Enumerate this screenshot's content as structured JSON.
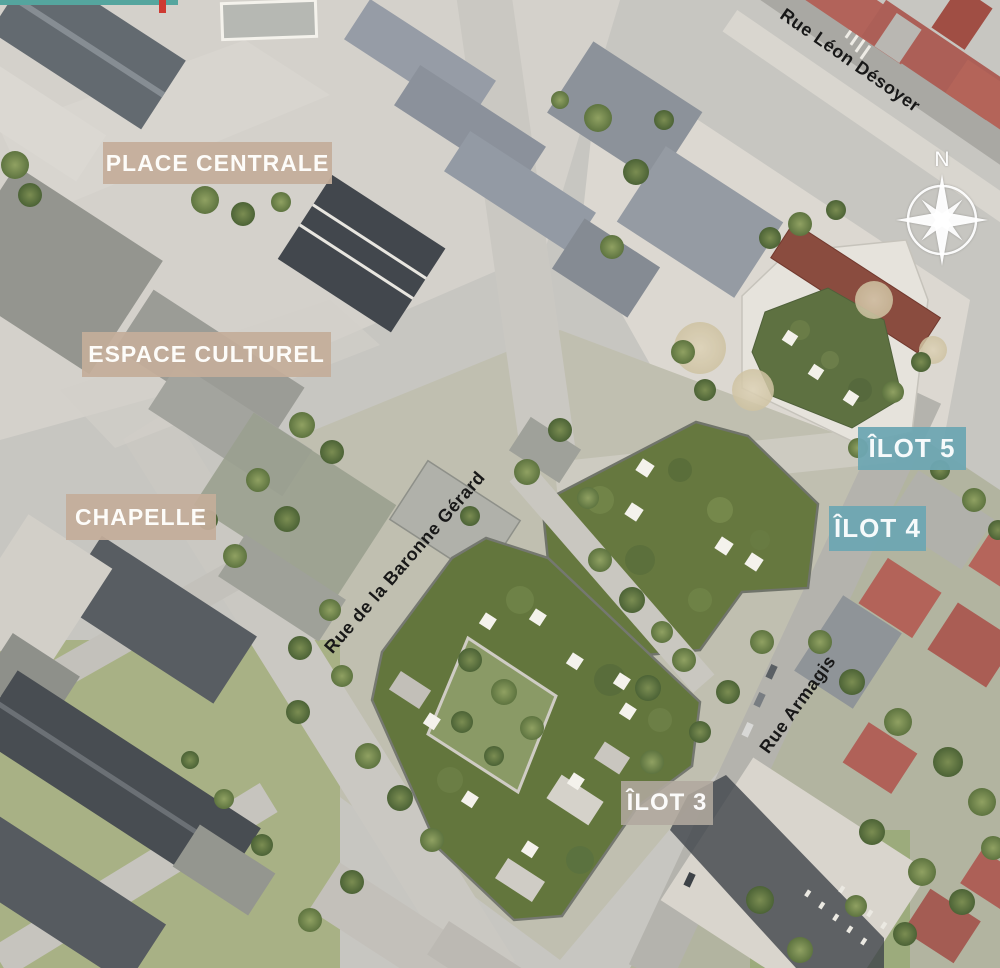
{
  "map": {
    "area_labels": [
      {
        "id": "place-centrale",
        "text": "PLACE CENTRALE"
      },
      {
        "id": "espace-culturel",
        "text": "ESPACE CULTUREL"
      },
      {
        "id": "chapelle",
        "text": "CHAPELLE"
      }
    ],
    "block_labels": [
      {
        "id": "ilot-5",
        "text": "ÎLOT 5"
      },
      {
        "id": "ilot-4",
        "text": "ÎLOT 4"
      },
      {
        "id": "ilot-3",
        "text": "ÎLOT 3"
      }
    ],
    "street_labels": [
      {
        "id": "rue-leon-desoyer",
        "text": "Rue Léon Désoyer"
      },
      {
        "id": "rue-de-la-baronne-gerard",
        "text": "Rue de la Baronne Gérard"
      },
      {
        "id": "rue-armagis",
        "text": "Rue Armagis"
      }
    ],
    "compass": {
      "north_label": "N",
      "icon": "compass-rose-icon"
    },
    "colors": {
      "area_label_bg": "#c4ad9a",
      "block_label_bg": "#6ea7b2",
      "ilot3_label_bg": "#b1a89e",
      "label_text": "#ffffff",
      "street_text": "#181818",
      "green_roof": "#66783f",
      "compass": "#ffffff",
      "red_roof": "#b2635a",
      "teal_strip": "#55a59e"
    }
  }
}
